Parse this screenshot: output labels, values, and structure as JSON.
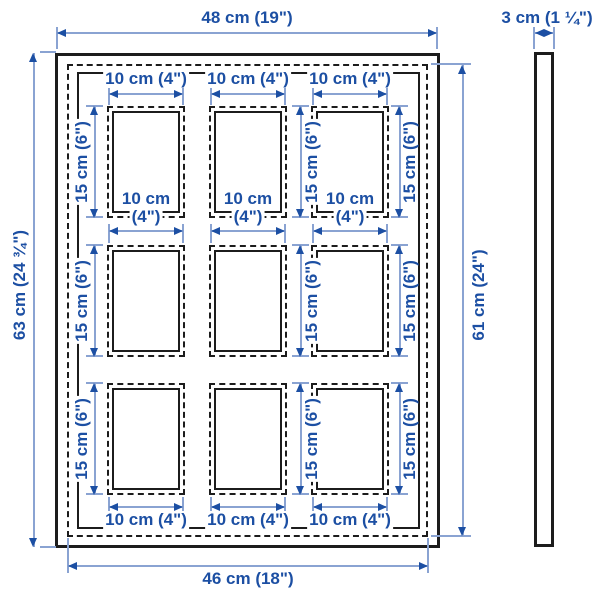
{
  "views": {
    "front": {
      "overall_width": "48 cm (19\")",
      "overall_height": "63 cm (24 ¾\")",
      "back_width": "46 cm (18\")",
      "back_height": "61 cm (24\")",
      "opening": {
        "width": "10 cm (4\")",
        "width_line1": "10 cm",
        "width_line2": "(4\")",
        "height": "15 cm (6\")",
        "rows": 3,
        "cols": 3
      }
    },
    "side": {
      "depth": "3 cm (1 ¼\")"
    }
  },
  "colors": {
    "dimension_text": "#1c4fa3",
    "dimension_line": "#8aa3d2",
    "frame_outline": "#1c1c1c",
    "background": "#ffffff"
  }
}
